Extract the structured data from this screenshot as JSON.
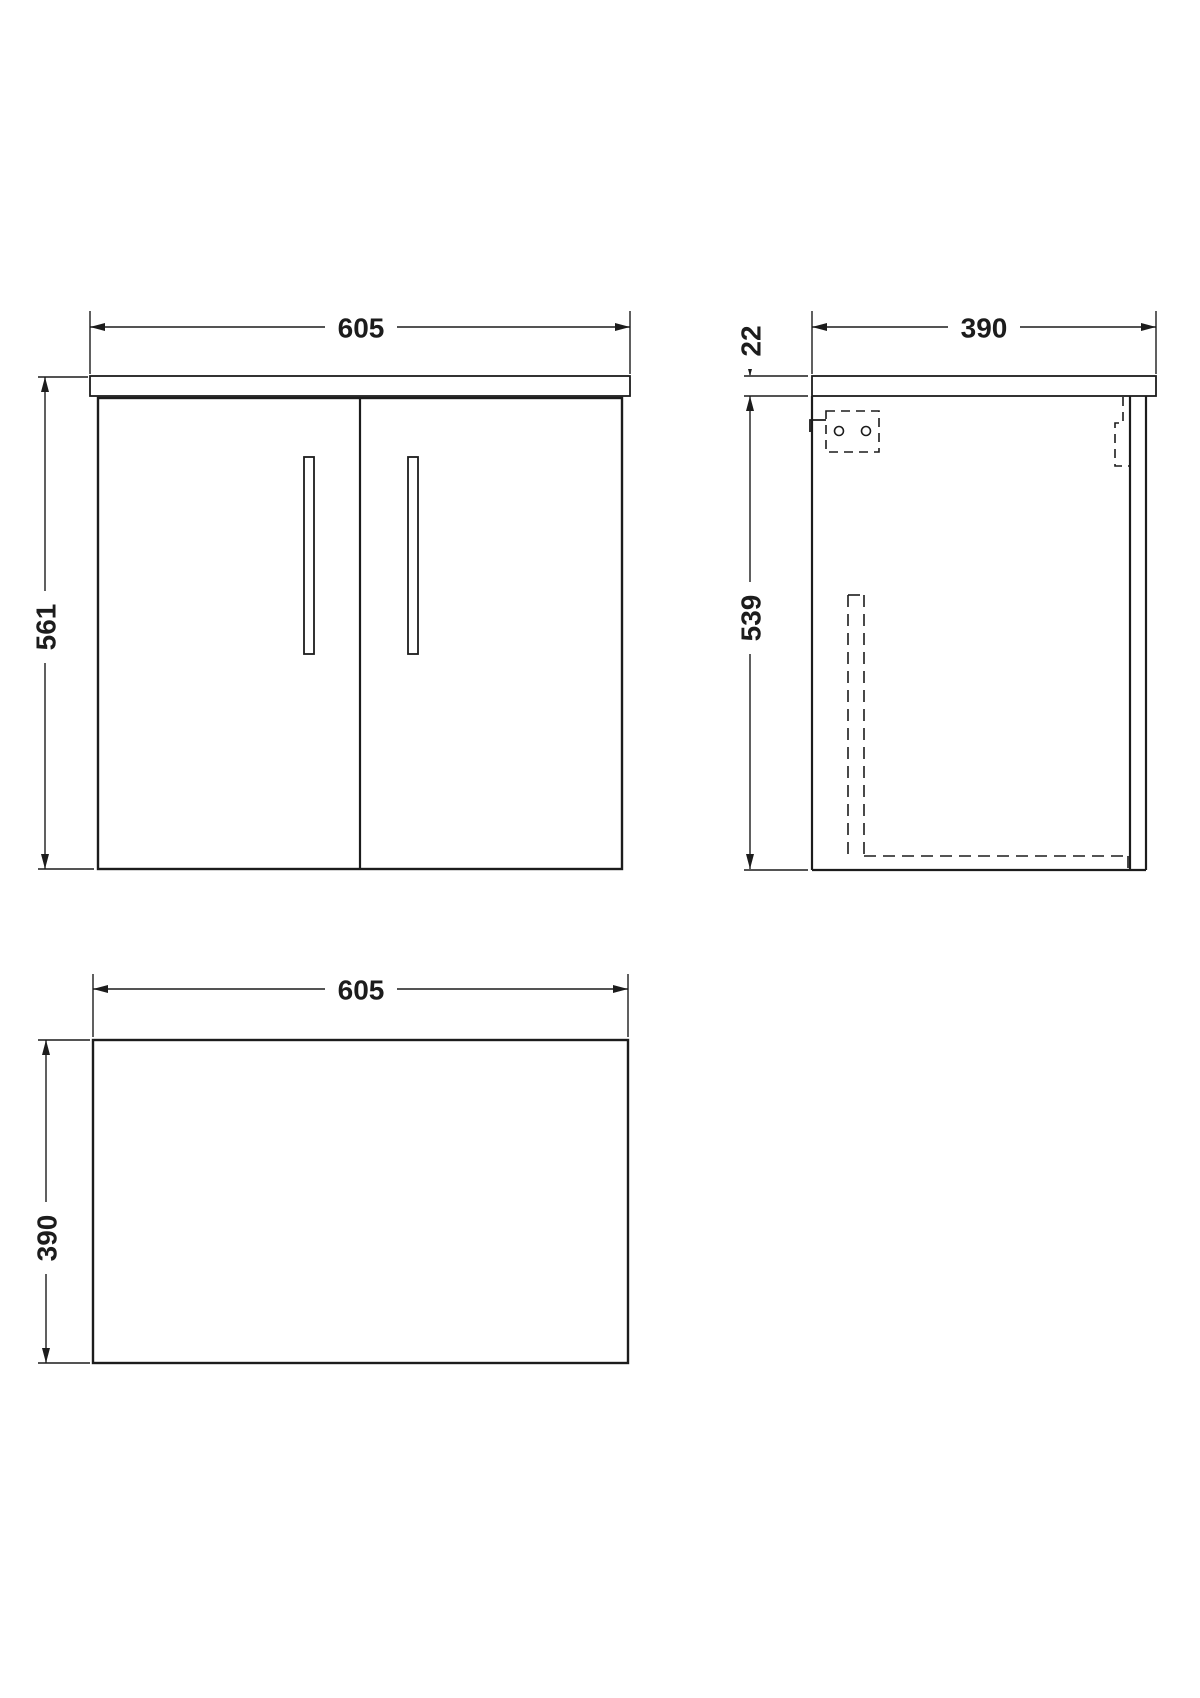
{
  "canvas": {
    "background": "#ffffff",
    "line_color": "#1c1c1c"
  },
  "views": {
    "front": {
      "width_mm": "605",
      "height_mm": "561"
    },
    "side": {
      "width_mm": "390",
      "worktop_thickness_mm": "22",
      "height_mm": "539"
    },
    "plan": {
      "width_mm": "605",
      "depth_mm": "390"
    }
  }
}
